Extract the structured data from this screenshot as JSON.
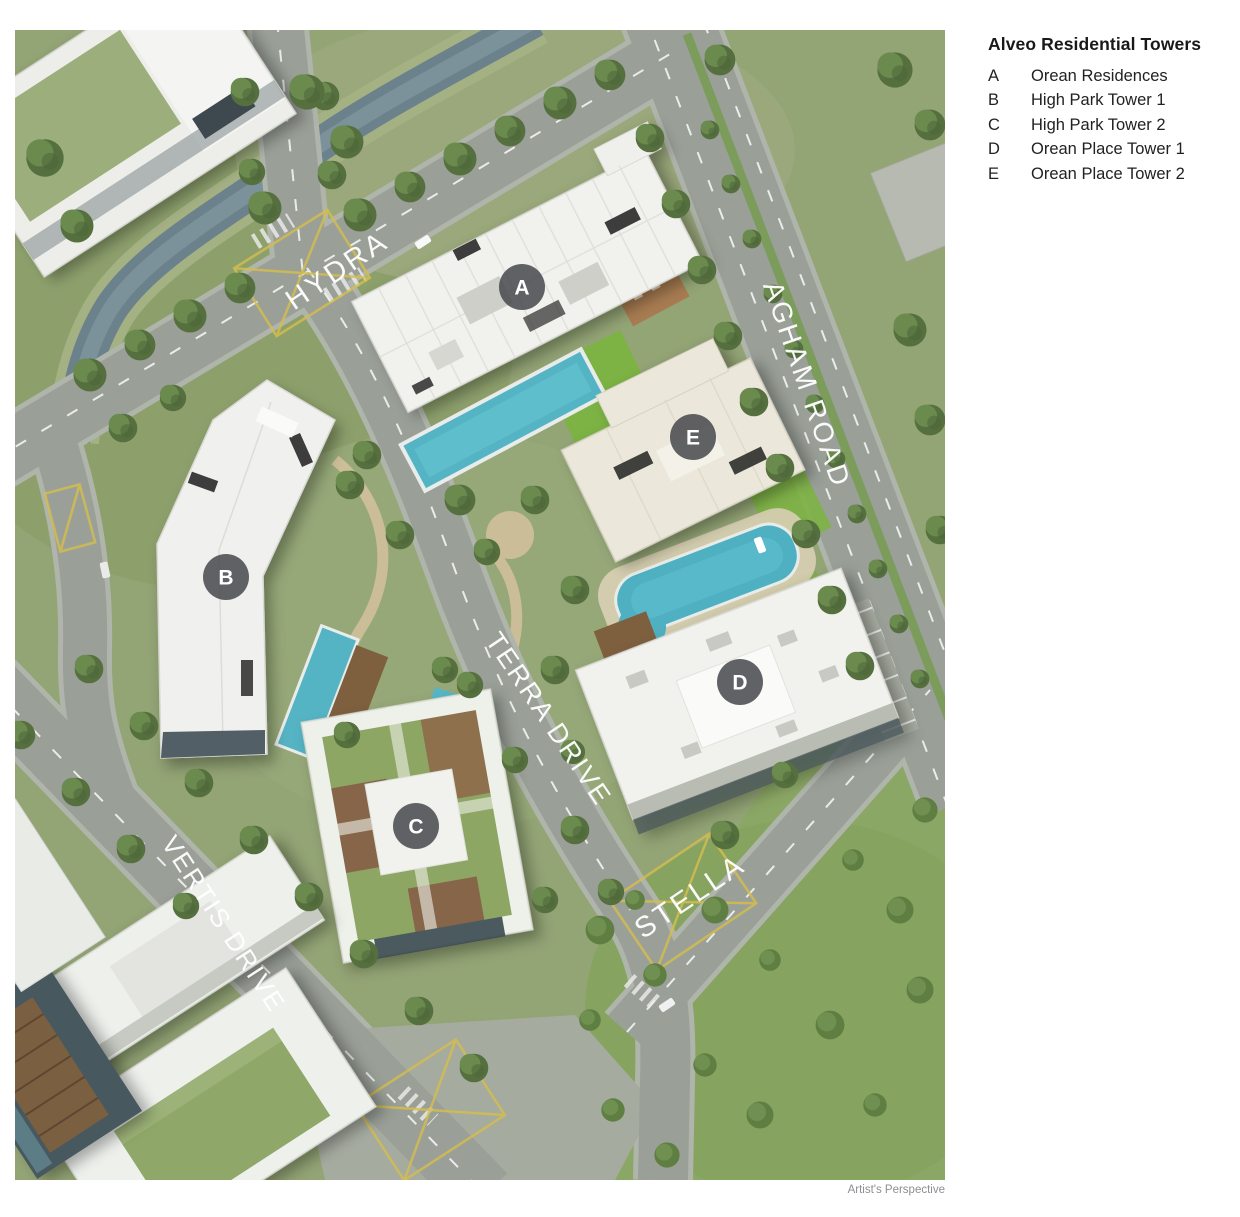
{
  "legend": {
    "title": "Alveo Residential Towers",
    "items": [
      {
        "letter": "A",
        "name": "Orean Residences"
      },
      {
        "letter": "B",
        "name": "High Park Tower 1"
      },
      {
        "letter": "C",
        "name": "High Park Tower 2"
      },
      {
        "letter": "D",
        "name": "Orean Place Tower 1"
      },
      {
        "letter": "E",
        "name": "Orean Place Tower 2"
      }
    ]
  },
  "map": {
    "caption": "Artist's Perspective",
    "roads": [
      {
        "name": "HYDRA"
      },
      {
        "name": "AGHAM ROAD"
      },
      {
        "name": "TERRA DRIVE"
      },
      {
        "name": "VERTIS DRIVE"
      },
      {
        "name": "STELLA"
      }
    ],
    "markers": [
      {
        "letter": "A"
      },
      {
        "letter": "B"
      },
      {
        "letter": "C"
      },
      {
        "letter": "D"
      },
      {
        "letter": "E"
      }
    ],
    "colors": {
      "marker_bg": "#4a4b4f",
      "road_label": "#ffffff",
      "grass": "#93a475",
      "road": "#9aa098",
      "pool": "#55b4c4",
      "legend_text": "#1a1a1a",
      "caption": "#8e8e93"
    }
  }
}
